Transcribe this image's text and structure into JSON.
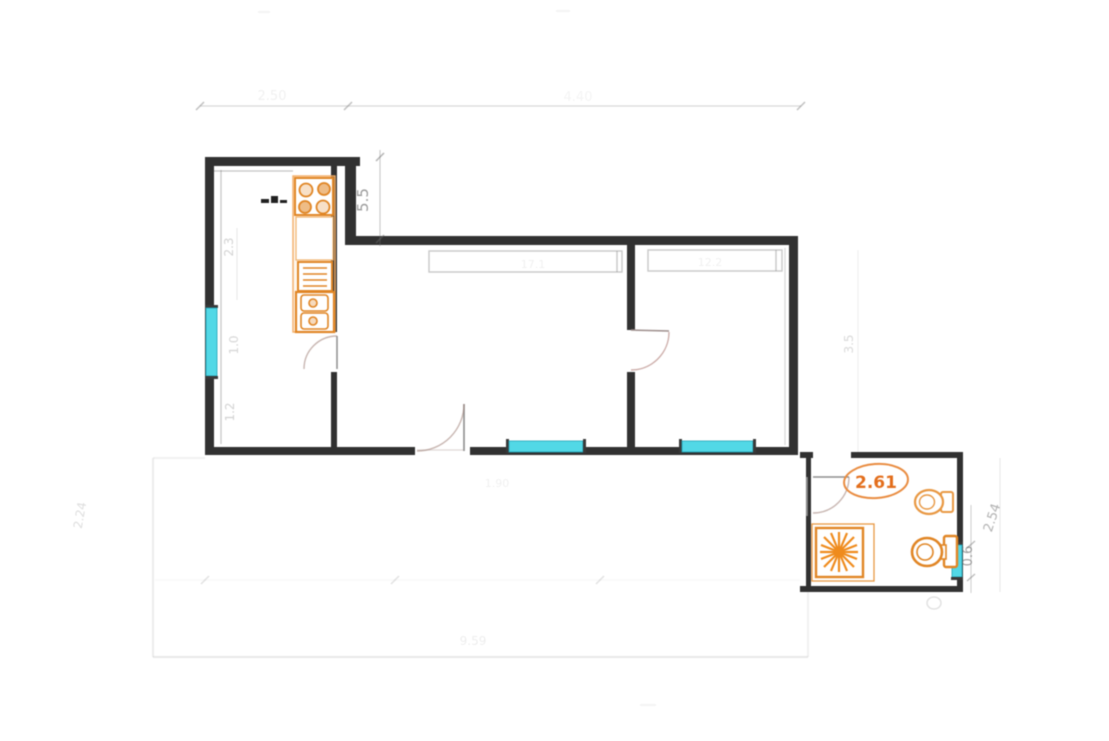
{
  "plan": {
    "type": "apartment-floor-plan",
    "colors": {
      "wall": "#2b2b2b",
      "window_glass": "#4dd7e6",
      "window_edge": "#18a0b4",
      "fixture_orange": "#e0821e",
      "fixture_orange_light": "#f2aa60",
      "door_arc": "#a08078",
      "dimension_gray": "#6f6f6f"
    },
    "dimensions": {
      "kitchen_height": "5.5",
      "bathroom_width": "2.61",
      "bathroom_window": "0.6",
      "bathroom_height": "2.54",
      "kitchen_wall_upper": "2.3",
      "kitchen_window": "1.0",
      "kitchen_wall_lower": "1.2",
      "right_side": "3.5",
      "terrace_left": "2.24",
      "top_left_span": "2.50",
      "top_right_span": "4.40",
      "terrace_bottom": "9.59",
      "entry_door": "1.90",
      "living_area": "17.1",
      "bedroom_area": "12.2"
    },
    "fixtures": {
      "stove": "4-burner stove",
      "sink": "double kitchen sink",
      "drainer": "drain board",
      "shower": "shower cabin",
      "toilet": "toilet",
      "bidet": "bidet"
    }
  }
}
